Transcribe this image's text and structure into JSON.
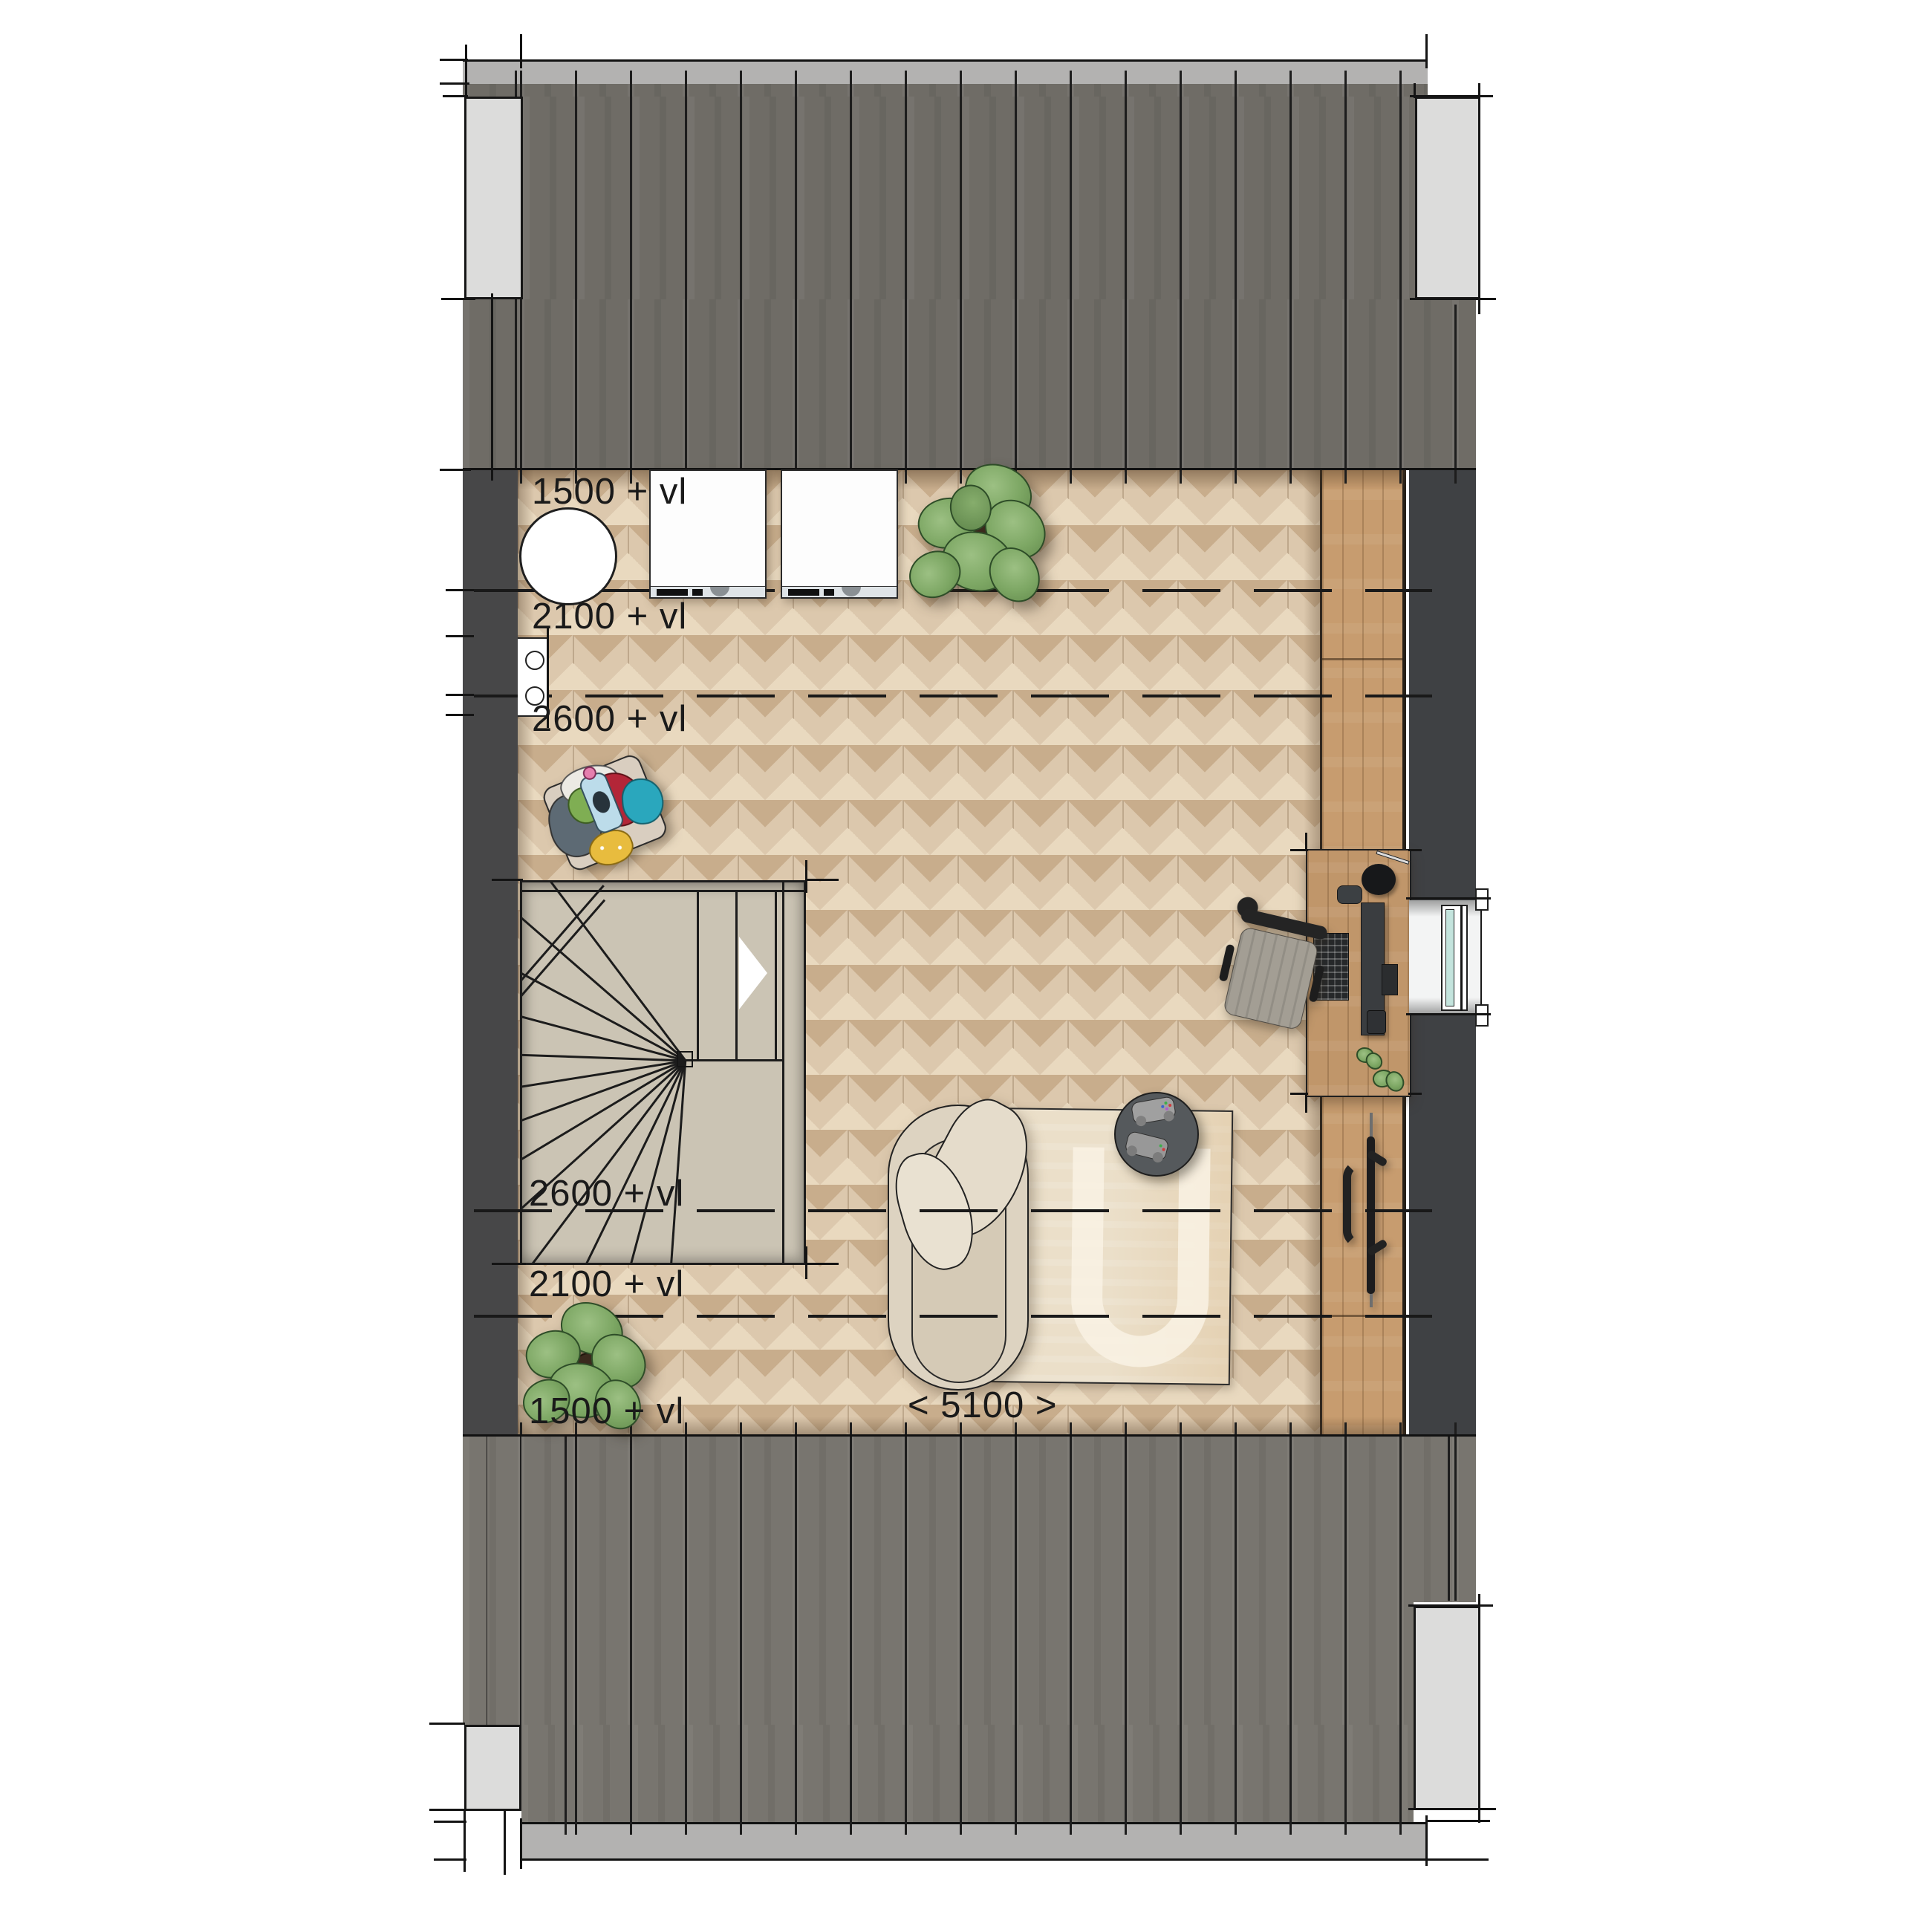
{
  "title": "Attic floor plan",
  "labels": {
    "h1500_top": "1500 + vl",
    "h2100_top": "2100 + vl",
    "h2600_top": "2600 + vl",
    "h2600_bottom": "2600 + vl",
    "h2100_bottom": "2100 + vl",
    "h1500_bottom": "1500 + vl",
    "room_width": "< 5100 >"
  },
  "colors": {
    "roof_top": "#6f6c66",
    "roof_bottom": "#78756f",
    "ridge_band": "#b3b2b1",
    "chimney": "#dcdcdb",
    "interior_wall": "#434447",
    "floor_wood": "#dcc8ad",
    "counter_wood": "#c79c6f",
    "stair": "#cbc4b4",
    "rug": "#ebdfc9",
    "lounge_chair": "#ddd3c1",
    "side_table": "#55595c",
    "window_glass": "#c4e4dd",
    "dimension_text": "#1a1a1a"
  },
  "objects": [
    "roof",
    "chimney",
    "spiral-staircase",
    "washing-machine",
    "washing-machine",
    "laundry-tub",
    "vent-shaft",
    "laundry-basket",
    "plant",
    "plant",
    "lounge-chair",
    "rug",
    "side-table-with-controllers",
    "desk-with-computer",
    "office-chair",
    "radiator",
    "window"
  ]
}
